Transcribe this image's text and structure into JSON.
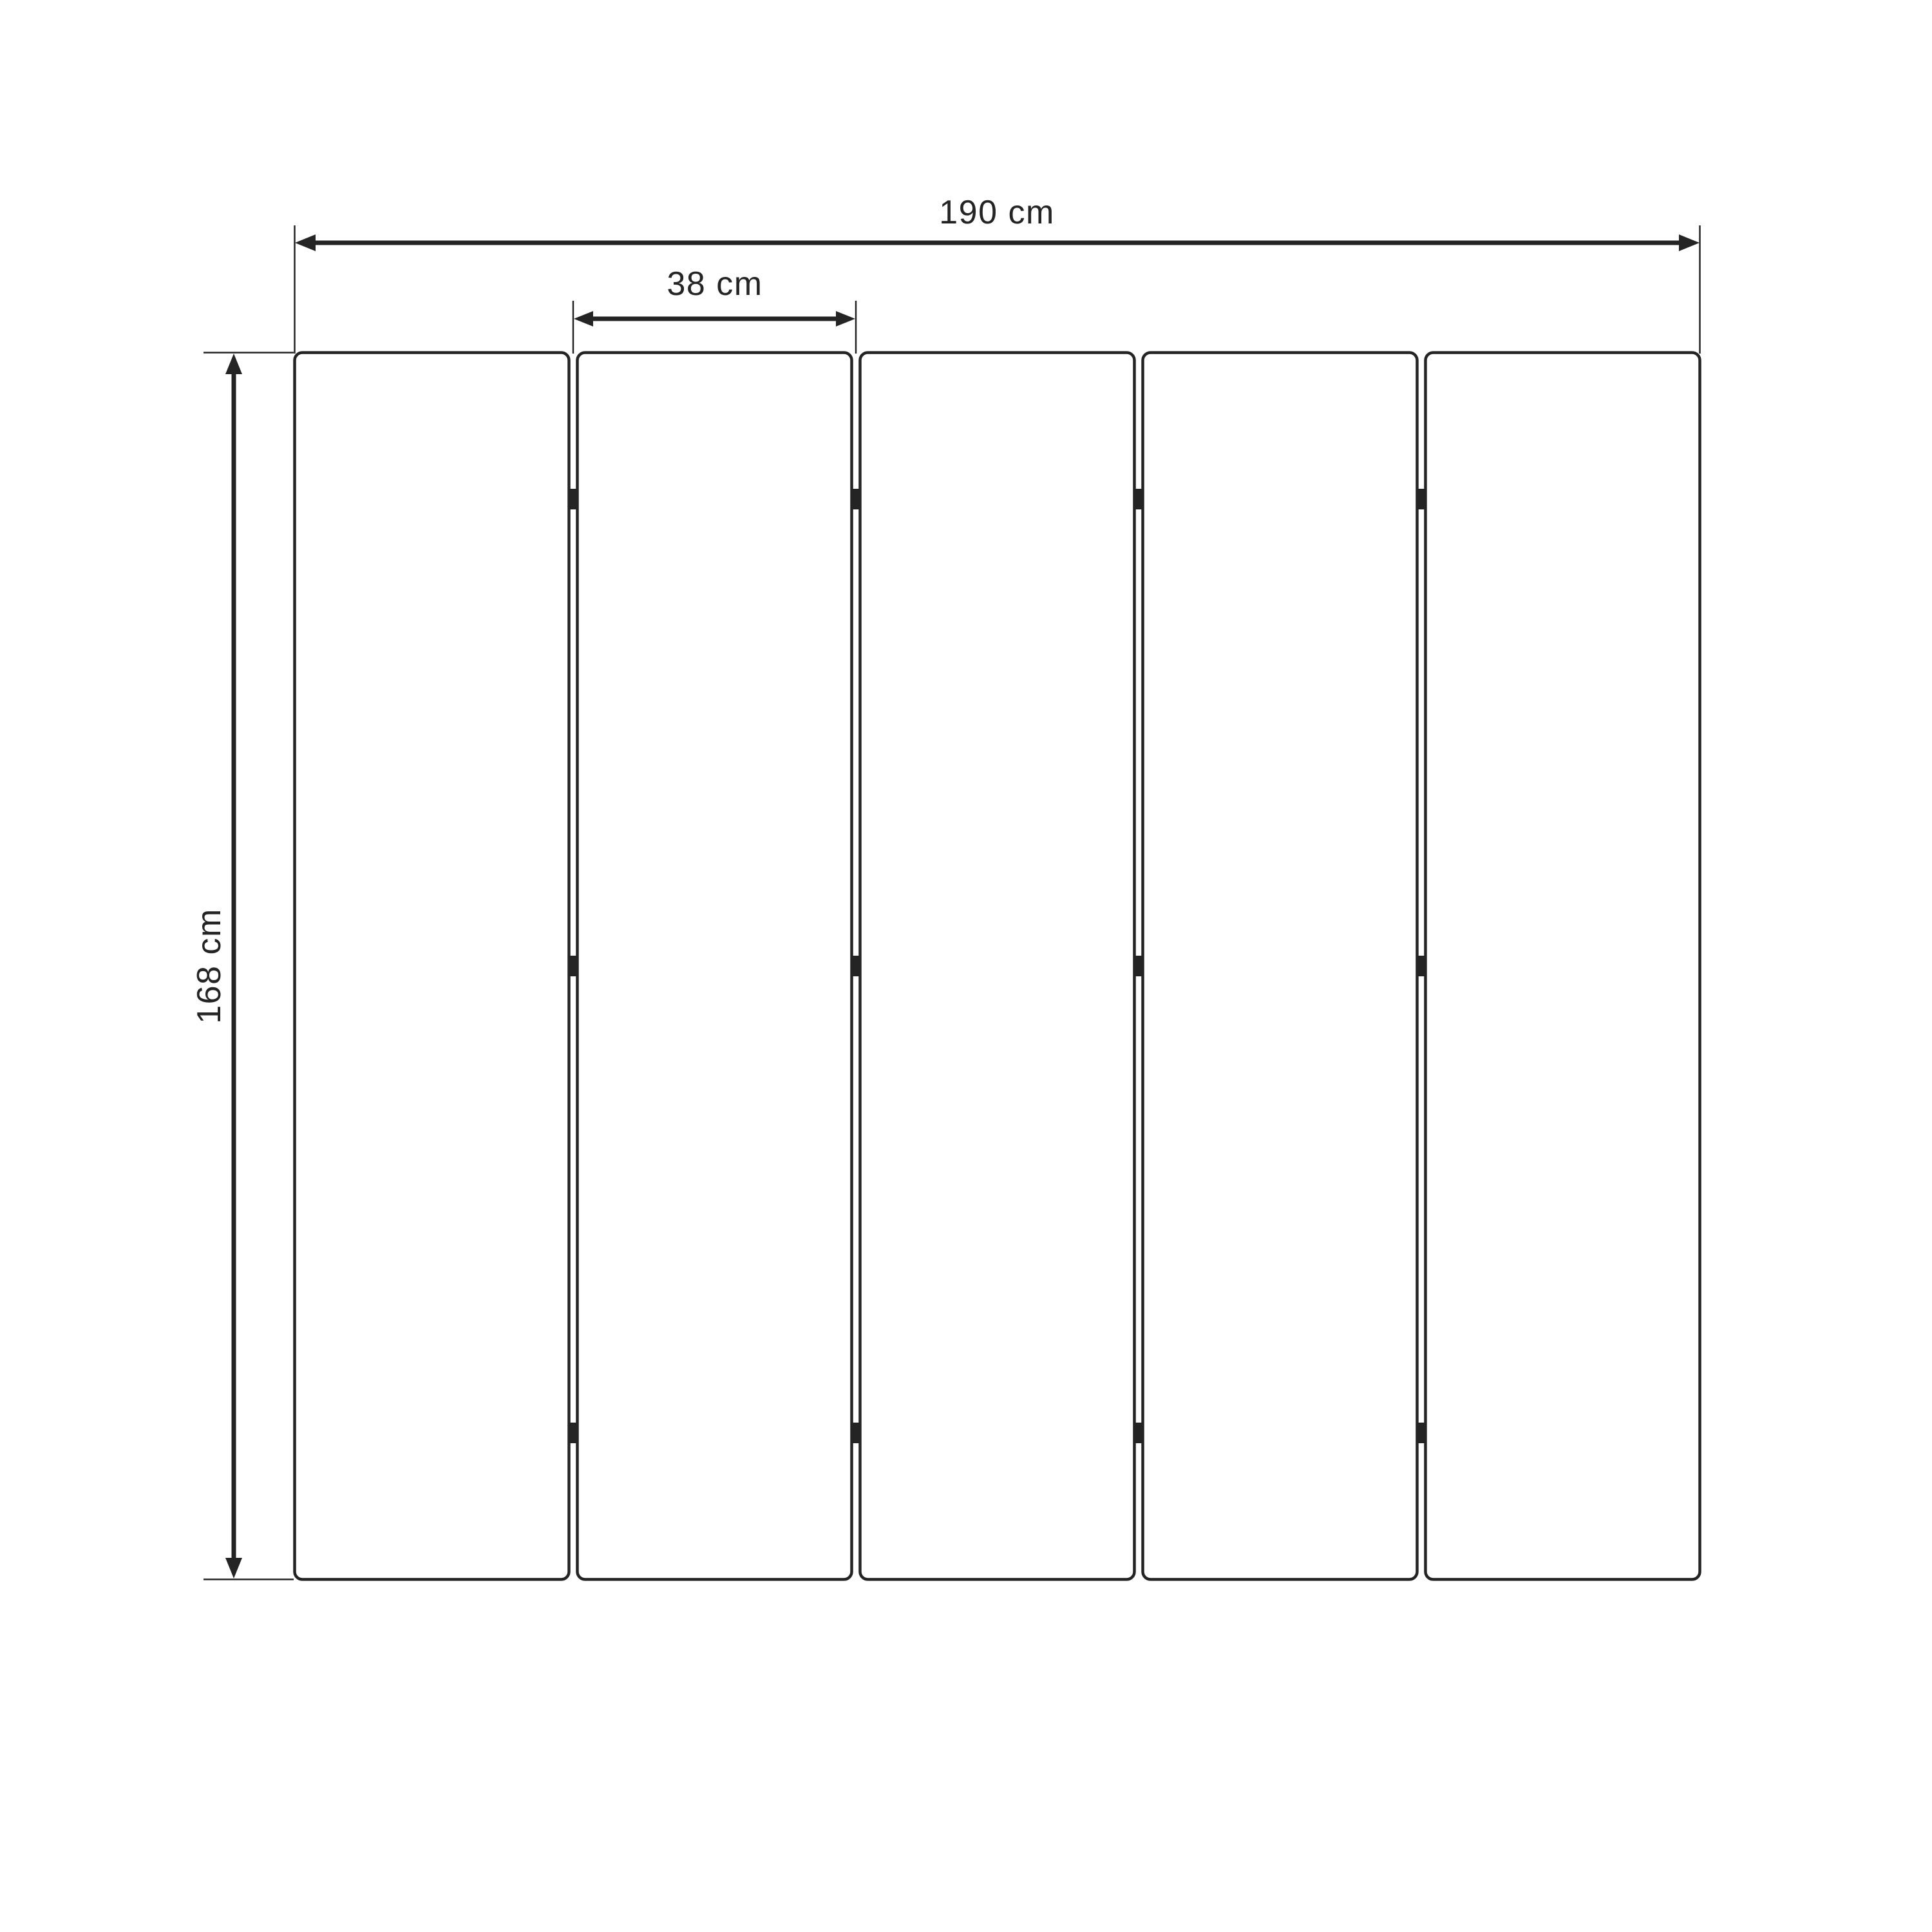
{
  "diagram": {
    "kind": "technical-dimension-drawing",
    "subject": "five-panel folding screen, front elevation",
    "panel_count": 5,
    "hinge_rows_per_gap": 3,
    "labels": {
      "total_width": "190 cm",
      "panel_width": "38 cm",
      "height": "168 cm"
    },
    "colors": {
      "line": "#242424",
      "panel_fill": "#ffffff",
      "background": "#ffffff"
    }
  }
}
